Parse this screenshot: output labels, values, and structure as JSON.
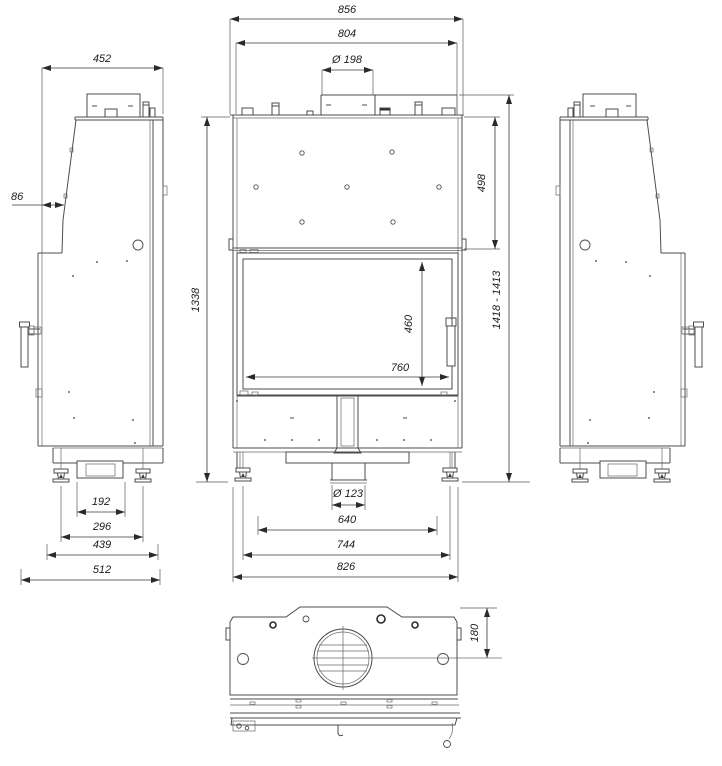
{
  "drawing": {
    "kind": "three-view dimensional technical drawing of a fireplace insert",
    "background": "#ffffff",
    "line_color": "#4c4c4c",
    "dim_color": "#1c1c1c"
  },
  "views": {
    "left_side": {
      "dims": {
        "top_depth": "452",
        "front_offset": "86",
        "drawer_width": "192",
        "feet_spacing": "296",
        "base_depth": "439",
        "overall_depth": "512"
      }
    },
    "front": {
      "dims": {
        "overall_width": "856",
        "body_width": "804",
        "flue_diameter": "Ø 198",
        "body_height": "1338",
        "upper_section_height": "498",
        "overall_height_range": "1418 - 1413",
        "glass_height": "460",
        "glass_width": "760",
        "outlet_diameter": "Ø 123",
        "inner_spacing": "640",
        "feet_spacing": "744",
        "base_width": "826"
      }
    },
    "top": {
      "dims": {
        "flue_center_offset": "180"
      }
    }
  }
}
